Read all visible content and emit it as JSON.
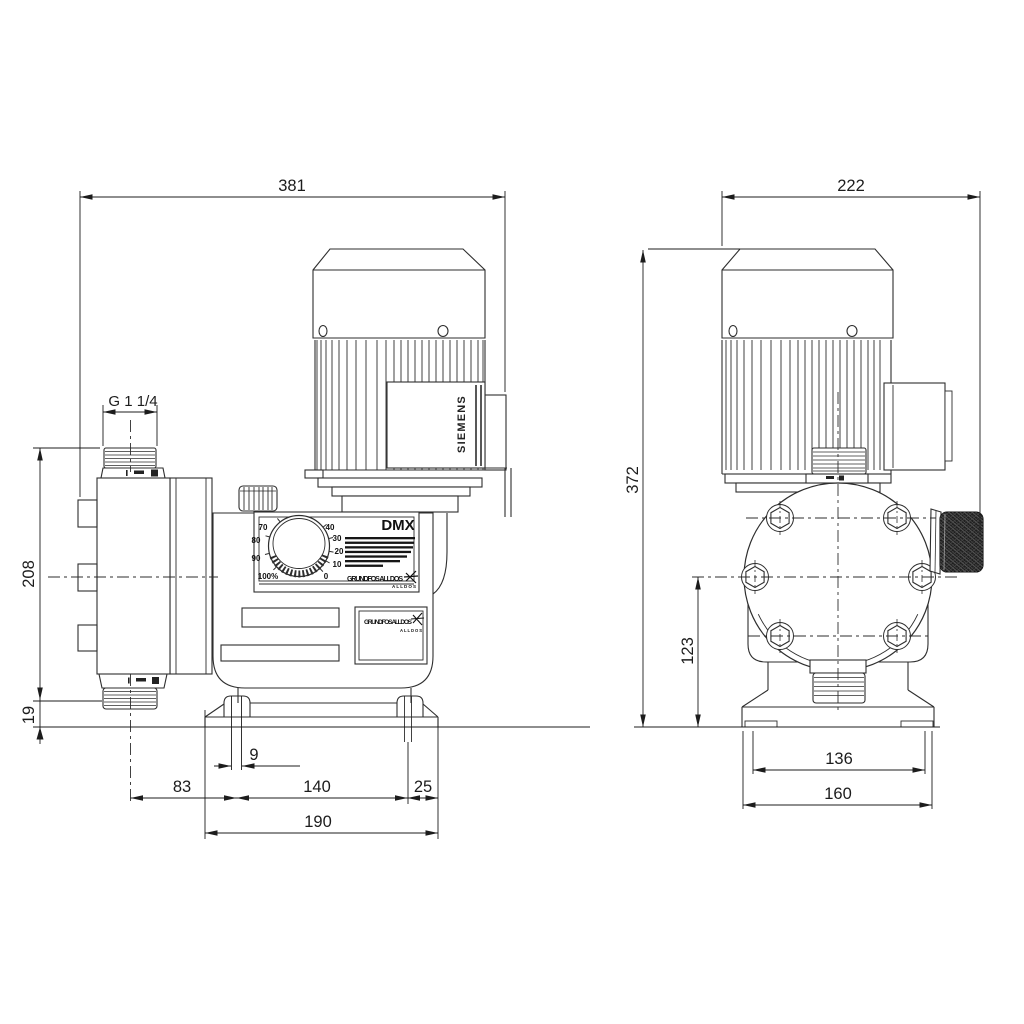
{
  "labels": {
    "model": "DMX",
    "motor_brand": "SIEMENS",
    "logo_wordmark": "GRUNDFOS ALLDOS",
    "logo_sub": "ALLDOS"
  },
  "knob": {
    "s0": "0",
    "s10": "10",
    "s20": "20",
    "s30": "30",
    "s40": "40",
    "s70": "70",
    "s80": "80",
    "s90": "90",
    "s100": "100%"
  },
  "dimensions": {
    "side_view": {
      "overall_width": "381",
      "port_thread": "G 1 1/4",
      "port_height": "208",
      "port_to_base": "19",
      "slot_width": "9",
      "port_center_to_slot": "83",
      "slot_spacing": "140",
      "slot_to_edge": "25",
      "base_width": "190"
    },
    "end_view": {
      "overall_width": "222",
      "overall_height": "372",
      "head_center_height": "123",
      "slot_spacing": "136",
      "base_width": "160"
    }
  }
}
